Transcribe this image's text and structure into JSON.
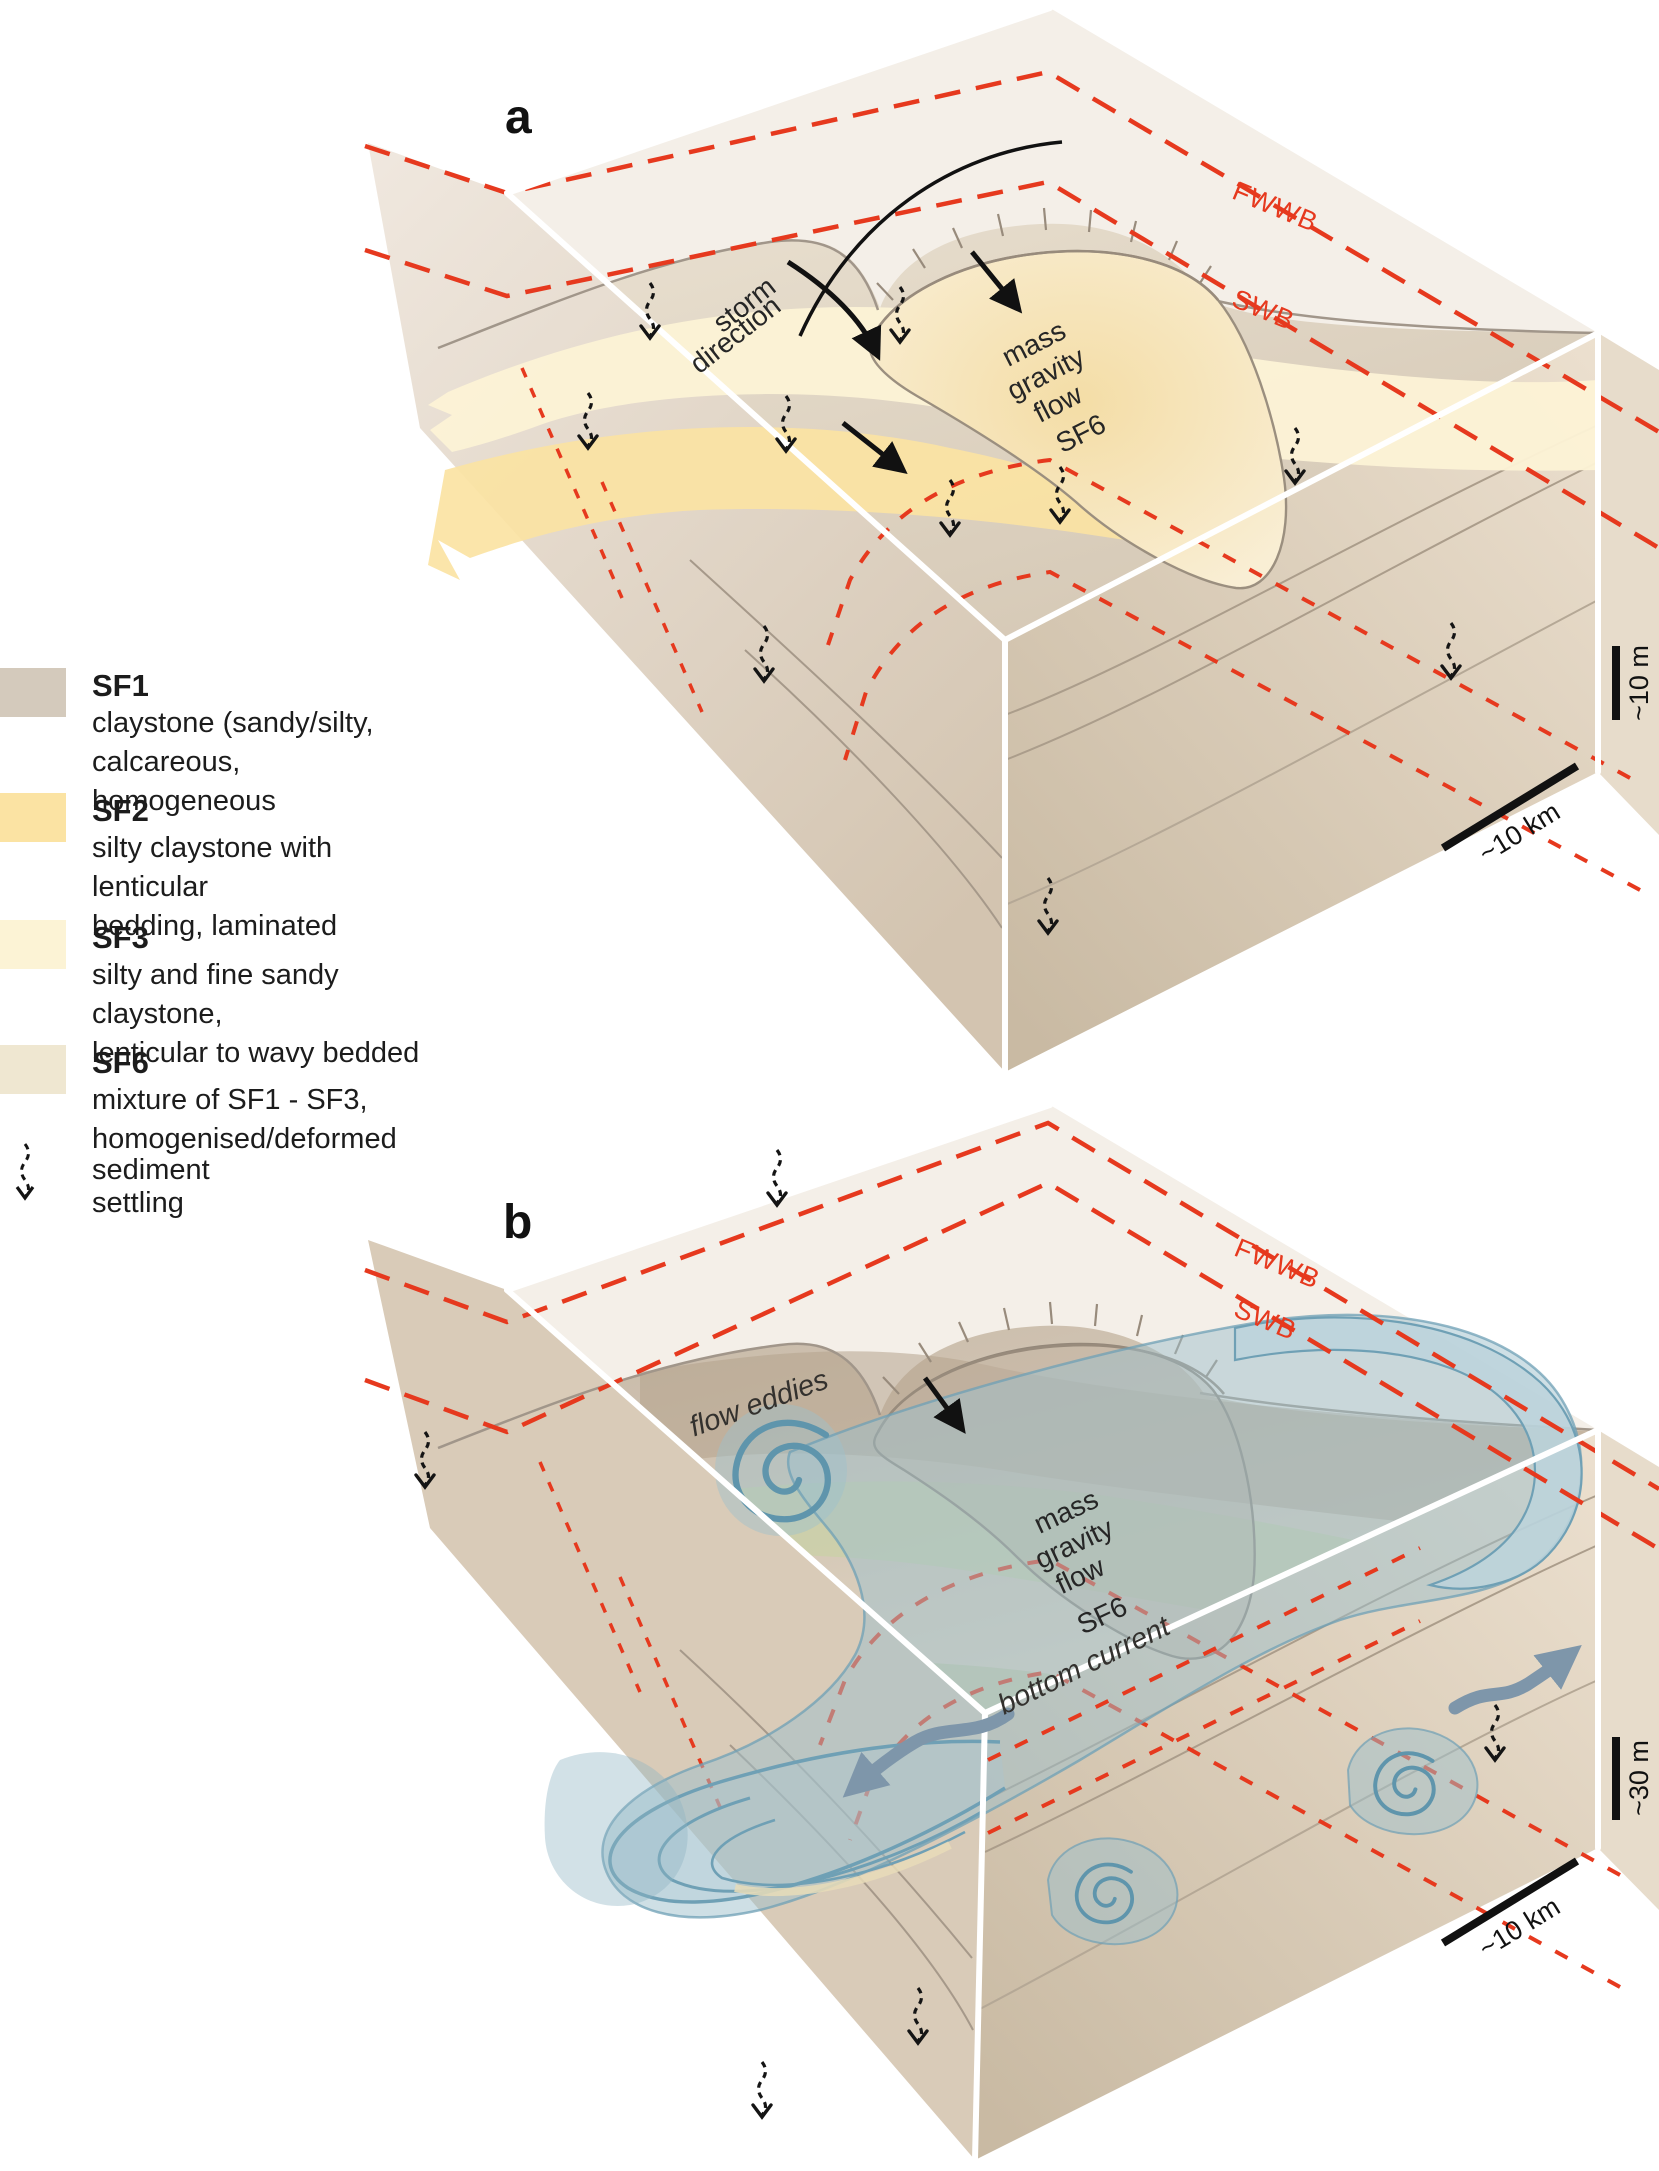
{
  "figure": {
    "type": "geological block diagram figure, two panels",
    "panel_count": 2
  },
  "colors": {
    "red_dashes": "#e6391e",
    "sf1": "#d4cabc",
    "sf2": "#fbe3a3",
    "sf3": "#fcf3d5",
    "sf6": "#efe7d1",
    "bottom_current_blue": "#9dc0cc",
    "eddy_line_blue": "#6fa0b5",
    "arrow_blue": "#7e96aa",
    "ink": "#1c1c1c"
  },
  "legend": {
    "items": [
      {
        "id": "SF1",
        "swatch_color": "#d4cabc",
        "title": "SF1",
        "desc_lines": [
          "claystone (sandy/silty,",
          "calcareous, homogeneous"
        ]
      },
      {
        "id": "SF2",
        "swatch_color": "#fbe3a3",
        "title": "SF2",
        "desc_lines": [
          "silty claystone with lenticular",
          "bedding, laminated"
        ]
      },
      {
        "id": "SF3",
        "swatch_color": "#fcf3d5",
        "title": "SF3",
        "desc_lines": [
          "silty and fine sandy claystone,",
          "lenticular to wavy bedded"
        ]
      },
      {
        "id": "SF6",
        "swatch_color": "#efe7d1",
        "title": "SF6",
        "desc_lines": [
          "mixture of SF1 - SF3,",
          "homogenised/deformed"
        ]
      }
    ],
    "settling_label": "sediment settling"
  },
  "panel_a": {
    "label": "a",
    "storm_direction_lines": [
      "storm",
      "direction"
    ],
    "mass_gravity_flow_lines": [
      "mass",
      "gravity",
      "flow"
    ],
    "sf6_label": "SF6",
    "fwwb_label": "FWWB",
    "swb_label": "SWB",
    "scale_vertical": "~10 m",
    "scale_horizontal": "~10 km"
  },
  "panel_b": {
    "label": "b",
    "flow_eddies_label": "flow eddies",
    "mass_gravity_flow_lines": [
      "mass",
      "gravity",
      "flow"
    ],
    "sf6_label": "SF6",
    "bottom_current_label": "bottom current",
    "fwwb_label": "FWWB",
    "swb_label": "SWB",
    "scale_vertical": "~30 m",
    "scale_horizontal": "~10 km"
  }
}
